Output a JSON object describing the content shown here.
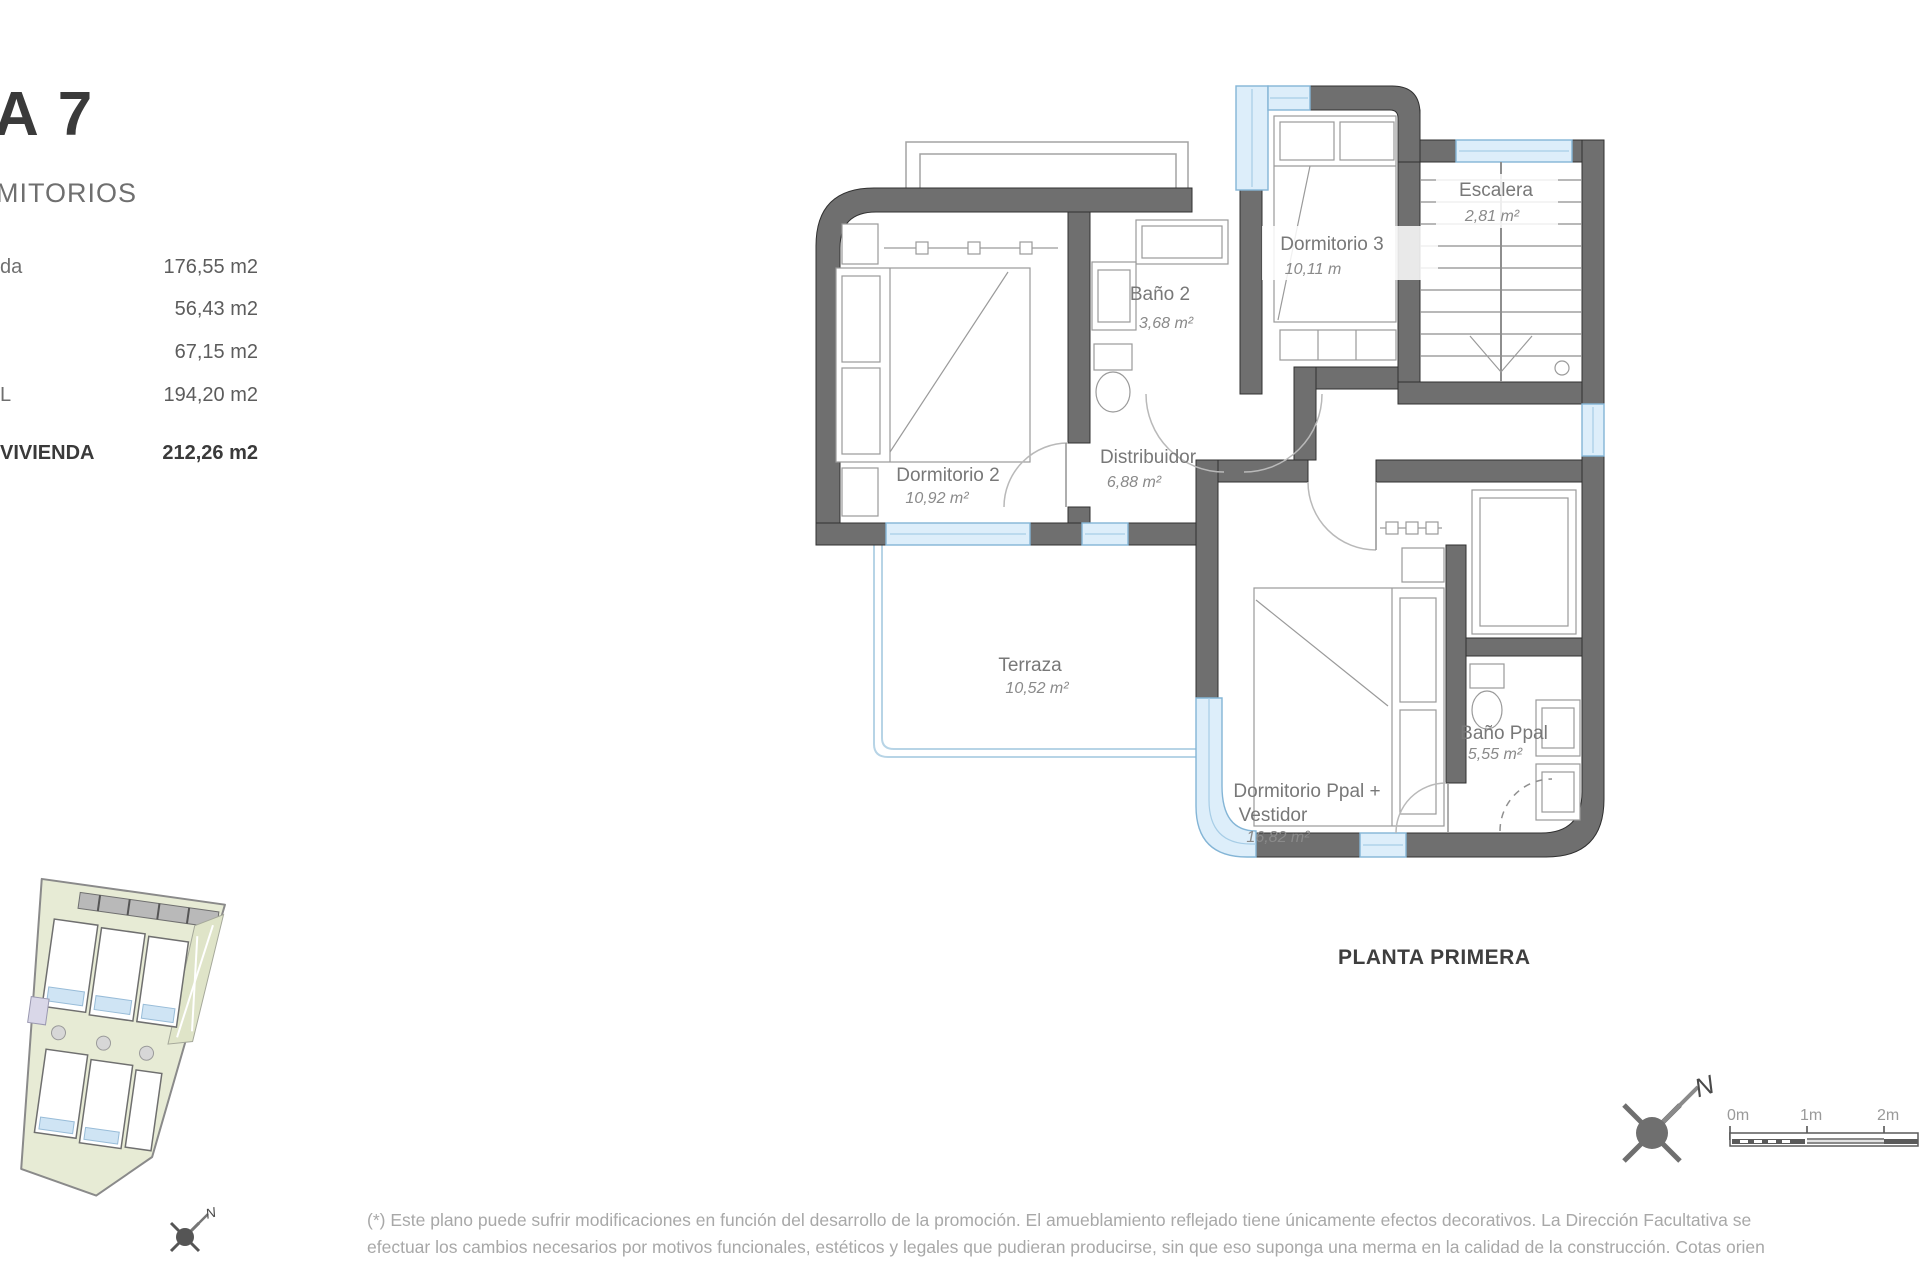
{
  "sidebar": {
    "title": "A 7",
    "subtitle": "MITORIOS",
    "rows": [
      {
        "label": "da",
        "value": "176,55 m2"
      },
      {
        "label": "",
        "value": "56,43 m2"
      },
      {
        "label": "",
        "value": "67,15 m2"
      },
      {
        "label": "L",
        "value": "194,20 m2"
      }
    ],
    "total": {
      "label": "VIVIENDA",
      "value": "212,26 m2"
    }
  },
  "plan": {
    "title": "PLANTA PRIMERA",
    "rooms": {
      "dormitorio2": {
        "name": "Dormitorio 2",
        "area": "10,92 m²"
      },
      "bano2": {
        "name": "Baño 2",
        "area": "3,68 m²"
      },
      "dormitorio3": {
        "name": "Dormitorio 3",
        "area": "10,11 m"
      },
      "escalera": {
        "name": "Escalera",
        "area": "2,81 m²"
      },
      "distribuidor": {
        "name": "Distribuidor",
        "area": "6,88 m²"
      },
      "terraza": {
        "name": "Terraza",
        "area": "10,52 m²"
      },
      "dormitorio_ppal": {
        "line1": "Dormitorio Ppal +",
        "line2": "Vestidor",
        "area": "16,82 m²"
      },
      "bano_ppal": {
        "name": "Baño Ppal",
        "area": "5,55 m²"
      }
    },
    "north_label": "N",
    "scale_labels": {
      "s0": "0m",
      "s1": "1m",
      "s2": "2m"
    }
  },
  "site_plan": {
    "north_label": "N"
  },
  "footer": {
    "line1": "(*) Este plano puede sufrir modificaciones en función del desarrollo de la promoción. El amueblamiento reflejado tiene únicamente efectos decorativos. La Dirección Facultativa se",
    "line2": "efectuar los cambios necesarios por motivos funcionales, estéticos y legales que pudieran producirse, sin que eso suponga una merma en la calidad de la construcción. Cotas orien"
  },
  "colors": {
    "wall_gray": "#6f6f6f",
    "window_blue": "#ddeefa",
    "window_frame": "#84b5d6",
    "label_gray": "#787878",
    "title_dark": "#3a3a3a",
    "footer_gray": "#a8a8a8",
    "site_green": "#e7ebd5"
  }
}
